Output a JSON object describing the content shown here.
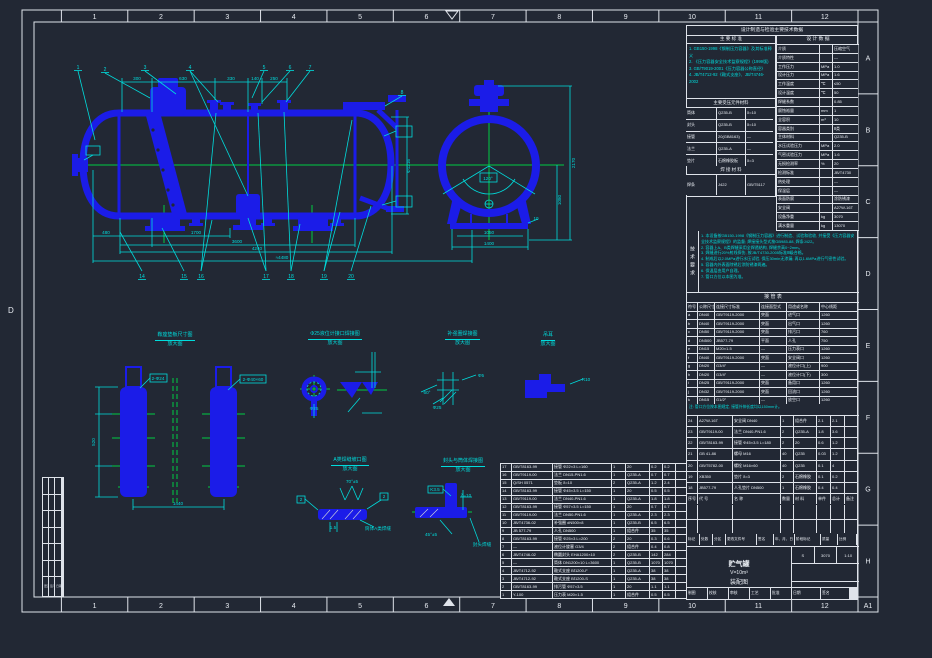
{
  "colors": {
    "blue": "#1b1ce8",
    "cyan": "#00dcdc",
    "green": "#00cd44",
    "line": "#dfe3ea",
    "paper": "#222834"
  },
  "sheet": {
    "grid_cols": [
      "1",
      "2",
      "3",
      "4",
      "5",
      "6",
      "7",
      "8",
      "9",
      "10",
      "11",
      "12"
    ],
    "grid_rows": [
      "A",
      "B",
      "C",
      "D",
      "E",
      "F",
      "G",
      "H"
    ],
    "corner_label": "A1",
    "left_letter": "D"
  },
  "drawing_labels": [
    "300",
    "630",
    "330",
    "140",
    "250",
    "480",
    "1700",
    "3600",
    "4240",
    "≈4480",
    "Φ1216",
    "2170",
    "1080",
    "1050",
    "1400",
    "120°",
    "10",
    "520",
    "2-Φ24",
    "2-Φ40×60",
    "1440",
    "Φ25",
    "60°",
    "Φ5",
    "Φ25",
    "R10",
    "70°±5",
    "2",
    "2",
    "1.5",
    "筒体A类焊缝",
    "K3.5",
    "45°±5",
    "封头焊缝",
    "δ=10"
  ],
  "tags_top": [
    "1",
    "2",
    "3",
    "4",
    "5",
    "6",
    "7",
    "8"
  ],
  "tags_bottom": [
    "14",
    "15",
    "16",
    "17",
    "18",
    "19",
    "20"
  ],
  "details": [
    {
      "title": "鞍座垫板尺寸图",
      "sub": "放大图"
    },
    {
      "title": "Φ25液位计接口焊接图",
      "sub": "放大图"
    },
    {
      "title": "补强圈焊接图",
      "sub": "放大图"
    },
    {
      "title": "吊耳",
      "sub": "放大图"
    },
    {
      "title": "A类焊缝坡口图",
      "sub": "放大图"
    },
    {
      "title": "封头与筒体焊接图",
      "sub": "放大图"
    }
  ],
  "rev_table": {
    "marks": [
      "更改",
      "签字",
      "日期"
    ]
  },
  "right_panel": {
    "header": "设计制造与检验主要技术数据",
    "standards": {
      "title": "主 要 标 准",
      "items": [
        "1. GB150-1998《钢制压力容器》及其标准释义",
        "2. 《压力容器安全技术监察规程》(1999版)",
        "3. GB/T9019-2001《压力容器公称直径》",
        "4. JB/T4712-92《鞍式支座》、JB/T4746-2002"
      ]
    },
    "materials": {
      "title": "主要受压元件材料",
      "rows": [
        [
          "筒体",
          "Q235-B",
          "δ=10"
        ],
        [
          "封头",
          "Q235-B",
          "δ=10"
        ],
        [
          "接管",
          "20(GB8163)",
          "—"
        ],
        [
          "法兰",
          "Q235-A",
          "—"
        ],
        [
          "垫片",
          "石棉橡胶板",
          "δ=3"
        ]
      ]
    },
    "weld": {
      "title": "焊 接 材 料",
      "row": [
        "焊条",
        "J422",
        "GB/T5117"
      ]
    },
    "design": {
      "title": "设 计 数 据",
      "rows": [
        [
          "介质",
          "",
          "压缩空气"
        ],
        [
          "介质特性",
          "",
          "—"
        ],
        [
          "工作压力",
          "MPa",
          "1.0"
        ],
        [
          "设计压力",
          "MPa",
          "1.6"
        ],
        [
          "工作温度",
          "℃",
          "≤50"
        ],
        [
          "设计温度",
          "℃",
          "50"
        ],
        [
          "焊缝系数",
          "",
          "0.85"
        ],
        [
          "腐蚀裕量",
          "mm",
          "1"
        ],
        [
          "全容积",
          "m³",
          "10"
        ],
        [
          "容器类别",
          "",
          "Ⅱ类"
        ],
        [
          "主体材料",
          "",
          "Q235-B"
        ],
        [
          "水压试验压力",
          "MPa",
          "2.0"
        ],
        [
          "气密试验压力",
          "MPa",
          "1.6"
        ],
        [
          "无损检测率",
          "%",
          "20"
        ],
        [
          "检测标准",
          "",
          "JB/T4730"
        ],
        [
          "热处理",
          "",
          "—"
        ],
        [
          "保温层",
          "",
          "—"
        ],
        [
          "表面防腐",
          "",
          "涂防锈漆"
        ],
        [
          "安全阀",
          "",
          "A27W-16T"
        ],
        [
          "设备净重",
          "kg",
          "3070"
        ],
        [
          "满水重量",
          "kg",
          "13070"
        ]
      ]
    },
    "tech": {
      "title": "技术要求",
      "items": [
        "1. 本设备按GB150-1998《钢制压力容器》进行制造、试验和验收, 并接受《压力容器安全技术监察规程》的监督; 焊接接头型式按GB985-88, 焊条J422。",
        "2. 容器上A、B类焊缝采用全焊透结构, 焊缝余高0~2mm。",
        "3. 焊缝进行20%射线探伤, 按JB/T4730-2005标准Ⅲ级合格。",
        "4. 制成后以2.0MPa进行水压试验, 保压30min无渗漏; 再以1.6MPa进行气密性试验。",
        "5. 容器内外表面除锈后涂防锈漆两遍。",
        "6. 保温层由用户自理。",
        "7. 管口方位以本图为准。"
      ]
    },
    "nozzle": {
      "title": "接  管  表",
      "headers": [
        "符号",
        "公称尺寸",
        "连接尺寸标准",
        "连接面型式",
        "用途或名称",
        "中心线距"
      ],
      "rows": [
        [
          "a",
          "DN40",
          "GB/T9119-2000",
          "突面",
          "进气口",
          "1260"
        ],
        [
          "b",
          "DN40",
          "GB/T9119-2000",
          "突面",
          "出气口",
          "1260"
        ],
        [
          "c",
          "DN50",
          "GB/T9119-2000",
          "突面",
          "排污口",
          "760"
        ],
        [
          "d",
          "DN500",
          "JB577-79",
          "平面",
          "人孔",
          "750"
        ],
        [
          "e",
          "DN15",
          "M20×1.5",
          "—",
          "压力表口",
          "1260"
        ],
        [
          "f",
          "DN40",
          "GB/T9119-2000",
          "突面",
          "安全阀口",
          "1260"
        ],
        [
          "g",
          "DN20",
          "G3/4″",
          "—",
          "液位计口(上)",
          "900"
        ],
        [
          "h",
          "DN20",
          "G3/4″",
          "—",
          "液位计口(下)",
          "300"
        ],
        [
          "i",
          "DN25",
          "GB/T9119-2000",
          "突面",
          "备用口",
          "1260"
        ],
        [
          "j",
          "DN32",
          "GB/T9119-2000",
          "突面",
          "回流口",
          "1260"
        ],
        [
          "k",
          "DN15",
          "G1/2″",
          "—",
          "放空口",
          "1260"
        ]
      ],
      "note": "注: 管口方位按本图规定, 接管外伸长度均以150mm计。"
    },
    "bom_upper": {
      "headers": [
        "序号",
        "代  号",
        "名  称",
        "数量",
        "材 料",
        "单件",
        "总计",
        "备注"
      ],
      "rows": [
        [
          "24",
          "A27W-16T",
          "安全阀 DN40",
          "1",
          "组合件",
          "2.1",
          "2.1",
          ""
        ],
        [
          "23",
          "GB/T9119-00",
          "法兰 DN40-PN1.6",
          "2",
          "Q235-A",
          "1.8",
          "3.6",
          ""
        ],
        [
          "22",
          "GB/T8163-99",
          "接管 Φ45×3.5 L=180",
          "2",
          "20",
          "0.6",
          "1.2",
          ""
        ],
        [
          "21",
          "GB 41-86",
          "螺母 M16",
          "40",
          "Q235",
          "0.03",
          "1.2",
          ""
        ],
        [
          "20",
          "GB/T5782-00",
          "螺栓 M16×60",
          "40",
          "Q235",
          "0.1",
          "4",
          ""
        ],
        [
          "19",
          "XB350",
          "垫片 δ=3",
          "2",
          "石棉橡胶",
          "0.1",
          "0.2",
          ""
        ],
        [
          "18",
          "JB577-79",
          "人孔垫片 DN500",
          "1",
          "石棉橡胶",
          "0.4",
          "0.4",
          ""
        ]
      ]
    }
  },
  "bom_main": {
    "rows": [
      [
        "17",
        "GB/T8163-99",
        "接管 Φ22×3 L=160",
        "1",
        "20",
        "0.2",
        "0.2",
        ""
      ],
      [
        "16",
        "GB/T9119-00",
        "法兰 DN15-PN1.6",
        "1",
        "Q235-A",
        "0.7",
        "0.7",
        ""
      ],
      [
        "15",
        "Q/SH 0571",
        "垫板 δ=10",
        "2",
        "Q235-A",
        "1.2",
        "2.4",
        ""
      ],
      [
        "14",
        "GB/T8163-99",
        "接管 Φ45×3.5 L=150",
        "1",
        "20",
        "0.5",
        "0.5",
        ""
      ],
      [
        "13",
        "GB/T9119-00",
        "法兰 DN40-PN1.6",
        "1",
        "Q235-A",
        "1.8",
        "1.8",
        ""
      ],
      [
        "12",
        "GB/T8163-99",
        "接管 Φ57×3.5 L=150",
        "1",
        "20",
        "0.7",
        "0.7",
        ""
      ],
      [
        "11",
        "GB/T9119-00",
        "法兰 DN50-PN1.6",
        "1",
        "Q235-A",
        "2.3",
        "2.3",
        ""
      ],
      [
        "10",
        "JB/T4736-02",
        "补强圈 dN500×8",
        "1",
        "Q235-B",
        "6.5",
        "6.5",
        ""
      ],
      [
        "9",
        "JB 577-79",
        "人孔 DN500",
        "1",
        "组合件",
        "35",
        "35",
        ""
      ],
      [
        "8",
        "GB/T8163-99",
        "接管 Φ25×3 L=200",
        "2",
        "20",
        "0.3",
        "0.6",
        ""
      ],
      [
        "7",
        "—",
        "液位计旋塞 G3/4",
        "2",
        "组合件",
        "0.4",
        "0.8",
        ""
      ],
      [
        "6",
        "JB/T4746-02",
        "椭圆封头 EHA1200×10",
        "2",
        "Q235-B",
        "142",
        "284",
        ""
      ],
      [
        "5",
        "—",
        "筒体 DN1200×10 L=3600",
        "1",
        "Q235-B",
        "1070",
        "1070",
        ""
      ],
      [
        "4",
        "JB/T4712-92",
        "鞍式支座 BⅠ1200-F",
        "1",
        "Q235-A",
        "38",
        "38",
        ""
      ],
      [
        "3",
        "JB/T4712-92",
        "鞍式支座 BⅠ1200-S",
        "1",
        "Q235-A",
        "38",
        "38",
        ""
      ],
      [
        "2",
        "GB/T8163-99",
        "排污管 Φ57×3.5",
        "1",
        "20",
        "1.1",
        "1.1",
        ""
      ],
      [
        "1",
        "Y-100",
        "压力表 M20×1.5",
        "1",
        "组合件",
        "0.5",
        "0.5",
        ""
      ]
    ]
  },
  "title_block": {
    "sig_headers": [
      "标记",
      "处数",
      "分区",
      "更改文件号",
      "签名",
      "年、月、日"
    ],
    "stage_headers": [
      "阶段标记",
      "质量",
      "比例"
    ],
    "stage": "S",
    "mass": "3070",
    "scale": "1:10",
    "product": "贮气罐",
    "spec": "V=10m³",
    "doc": "装配图",
    "sheets": "共 1 张  第 1 张",
    "bottom_cells": [
      "制图",
      "校核",
      "审核",
      "工艺",
      "批准",
      "日期",
      "签名"
    ]
  }
}
